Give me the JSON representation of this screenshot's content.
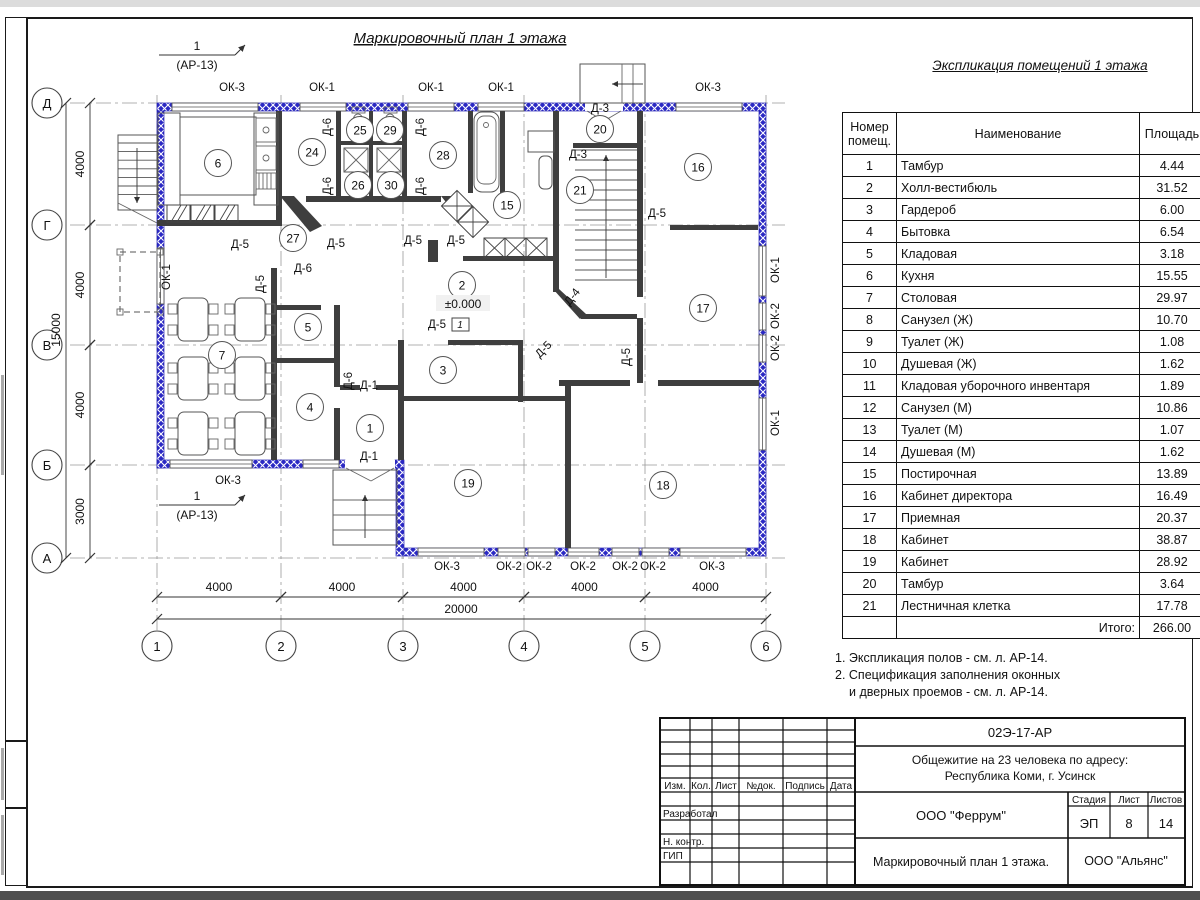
{
  "plan": {
    "title": "Маркировочный план 1 этажа",
    "axis_cols": [
      {
        "t": "1",
        "x": 157
      },
      {
        "t": "2",
        "x": 281
      },
      {
        "t": "3",
        "x": 403
      },
      {
        "t": "4",
        "x": 524
      },
      {
        "t": "5",
        "x": 645
      },
      {
        "t": "6",
        "x": 766
      }
    ],
    "axis_rows": [
      {
        "t": "Д",
        "y": 103
      },
      {
        "t": "Г",
        "y": 225
      },
      {
        "t": "В",
        "y": 345
      },
      {
        "t": "Б",
        "y": 465
      },
      {
        "t": "А",
        "y": 558
      }
    ],
    "dims_bottom": {
      "spans": [
        {
          "t": "4000",
          "a": 157,
          "b": 281
        },
        {
          "t": "4000",
          "a": 281,
          "b": 403
        },
        {
          "t": "4000",
          "a": 403,
          "b": 524
        },
        {
          "t": "4000",
          "a": 524,
          "b": 645
        },
        {
          "t": "4000",
          "a": 645,
          "b": 766
        }
      ],
      "total": "20000"
    },
    "dims_left": {
      "spans": [
        {
          "t": "4000",
          "a": 103,
          "b": 225
        },
        {
          "t": "4000",
          "a": 225,
          "b": 345
        },
        {
          "t": "4000",
          "a": 345,
          "b": 465
        },
        {
          "t": "3000",
          "a": 465,
          "b": 558
        }
      ],
      "total": "15000"
    },
    "window_labels": [
      {
        "t": "ОК-3",
        "x": 232,
        "y": 91
      },
      {
        "t": "ОК-1",
        "x": 322,
        "y": 91
      },
      {
        "t": "ОК-1",
        "x": 431,
        "y": 91
      },
      {
        "t": "ОК-1",
        "x": 501,
        "y": 91
      },
      {
        "t": "ОК-3",
        "x": 708,
        "y": 91
      },
      {
        "t": "ОК-3",
        "x": 228,
        "y": 484
      },
      {
        "t": "ОК-3",
        "x": 447,
        "y": 570
      },
      {
        "t": "ОК-2",
        "x": 509,
        "y": 570
      },
      {
        "t": "ОК-2",
        "x": 539,
        "y": 570
      },
      {
        "t": "ОК-2",
        "x": 583,
        "y": 570
      },
      {
        "t": "ОК-2",
        "x": 625,
        "y": 570
      },
      {
        "t": "ОК-2",
        "x": 653,
        "y": 570
      },
      {
        "t": "ОК-3",
        "x": 712,
        "y": 570
      },
      {
        "t": "ОК-1",
        "x": 779,
        "y": 270,
        "r": -90
      },
      {
        "t": "ОК-2",
        "x": 779,
        "y": 316,
        "r": -90
      },
      {
        "t": "ОК-2",
        "x": 779,
        "y": 348,
        "r": -90
      },
      {
        "t": "ОК-1",
        "x": 779,
        "y": 423,
        "r": -90
      },
      {
        "t": "ОК-1",
        "x": 170,
        "y": 277,
        "r": -90
      }
    ],
    "door_labels": [
      {
        "t": "Д-6",
        "x": 331,
        "y": 127,
        "r": -90
      },
      {
        "t": "Д-6",
        "x": 424,
        "y": 127,
        "r": -90
      },
      {
        "t": "Д-6",
        "x": 331,
        "y": 186,
        "r": -90
      },
      {
        "t": "Д-6",
        "x": 424,
        "y": 186,
        "r": -90
      },
      {
        "t": "Д-3",
        "x": 600,
        "y": 112
      },
      {
        "t": "Д-3",
        "x": 578,
        "y": 158
      },
      {
        "t": "Д-5",
        "x": 657,
        "y": 217
      },
      {
        "t": "Д-5",
        "x": 240,
        "y": 248
      },
      {
        "t": "Д-5",
        "x": 336,
        "y": 247
      },
      {
        "t": "Д-6",
        "x": 303,
        "y": 272
      },
      {
        "t": "Д-5",
        "x": 264,
        "y": 284,
        "r": -90
      },
      {
        "t": "Д-5",
        "x": 413,
        "y": 244
      },
      {
        "t": "Д-5",
        "x": 456,
        "y": 244
      },
      {
        "t": "Д-6",
        "x": 352,
        "y": 381,
        "r": -90
      },
      {
        "t": "Д-1",
        "x": 369,
        "y": 389
      },
      {
        "t": "Д-1",
        "x": 369,
        "y": 460
      },
      {
        "t": "Д-5",
        "x": 437,
        "y": 328
      },
      {
        "t": "Д-4",
        "x": 575,
        "y": 299,
        "r": -52
      },
      {
        "t": "Д-5",
        "x": 630,
        "y": 357,
        "r": -90
      },
      {
        "t": "Д-5",
        "x": 546,
        "y": 352,
        "r": -45
      }
    ],
    "rooms": [
      {
        "n": "1",
        "x": 370,
        "y": 428
      },
      {
        "n": "2",
        "x": 462,
        "y": 285
      },
      {
        "n": "3",
        "x": 443,
        "y": 370
      },
      {
        "n": "4",
        "x": 310,
        "y": 407
      },
      {
        "n": "5",
        "x": 308,
        "y": 327
      },
      {
        "n": "6",
        "x": 218,
        "y": 163
      },
      {
        "n": "7",
        "x": 222,
        "y": 355
      },
      {
        "n": "15",
        "x": 507,
        "y": 205
      },
      {
        "n": "16",
        "x": 698,
        "y": 167
      },
      {
        "n": "17",
        "x": 703,
        "y": 308
      },
      {
        "n": "18",
        "x": 663,
        "y": 485
      },
      {
        "n": "19",
        "x": 468,
        "y": 483
      },
      {
        "n": "20",
        "x": 600,
        "y": 129
      },
      {
        "n": "21",
        "x": 580,
        "y": 190
      },
      {
        "n": "24",
        "x": 312,
        "y": 152
      },
      {
        "n": "25",
        "x": 360,
        "y": 130
      },
      {
        "n": "26",
        "x": 358,
        "y": 185
      },
      {
        "n": "27",
        "x": 293,
        "y": 238
      },
      {
        "n": "28",
        "x": 443,
        "y": 155
      },
      {
        "n": "29",
        "x": 390,
        "y": 130
      },
      {
        "n": "30",
        "x": 391,
        "y": 185
      }
    ],
    "section_markers": [
      {
        "num": "1",
        "ref": "(АР-13)",
        "x": 197,
        "y": 55
      },
      {
        "num": "1",
        "ref": "(АР-13)",
        "x": 197,
        "y": 505
      }
    ],
    "level_mark": "±0.000",
    "floor_mark": "1"
  },
  "schedule": {
    "title": "Экспликация помещений 1 этажа",
    "headers": {
      "num1": "Номер",
      "num2": "помещ.",
      "name": "Наименование",
      "area": "Площадь",
      "cut1": "Ка",
      "cut2": "по"
    },
    "rows": [
      {
        "n": "1",
        "name": "Тамбур",
        "area": "4.44"
      },
      {
        "n": "2",
        "name": "Холл-вестибюль",
        "area": "31.52"
      },
      {
        "n": "3",
        "name": "Гардероб",
        "area": "6.00"
      },
      {
        "n": "4",
        "name": "Бытовка",
        "area": "6.54"
      },
      {
        "n": "5",
        "name": "Кладовая",
        "area": "3.18"
      },
      {
        "n": "6",
        "name": "Кухня",
        "area": "15.55"
      },
      {
        "n": "7",
        "name": "Столовая",
        "area": "29.97"
      },
      {
        "n": "8",
        "name": "Санузел (Ж)",
        "area": "10.70"
      },
      {
        "n": "9",
        "name": "Туалет (Ж)",
        "area": "1.08"
      },
      {
        "n": "10",
        "name": "Душевая (Ж)",
        "area": "1.62"
      },
      {
        "n": "11",
        "name": "Кладовая уборочного инвентаря",
        "area": "1.89"
      },
      {
        "n": "12",
        "name": "Санузел (М)",
        "area": "10.86"
      },
      {
        "n": "13",
        "name": "Туалет (М)",
        "area": "1.07"
      },
      {
        "n": "14",
        "name": "Душевая (М)",
        "area": "1.62"
      },
      {
        "n": "15",
        "name": "Постирочная",
        "area": "13.89"
      },
      {
        "n": "16",
        "name": "Кабинет директора",
        "area": "16.49"
      },
      {
        "n": "17",
        "name": "Приемная",
        "area": "20.37"
      },
      {
        "n": "18",
        "name": "Кабинет",
        "area": "38.87"
      },
      {
        "n": "19",
        "name": "Кабинет",
        "area": "28.92"
      },
      {
        "n": "20",
        "name": "Тамбур",
        "area": "3.64"
      },
      {
        "n": "21",
        "name": "Лестничная клетка",
        "area": "17.78"
      }
    ],
    "total_label": "Итого:",
    "total": "266.00"
  },
  "notes": [
    {
      "text": "1. Экспликация полов - см. л. АР-14.",
      "indent": false
    },
    {
      "text": "2. Спецификация заполнения оконных",
      "indent": false
    },
    {
      "text": "и дверных проемов - см. л. АР-14.",
      "indent": true
    }
  ],
  "titleblock": {
    "labels": [
      {
        "t": "Изм.",
        "x": 675,
        "y": 789,
        "s": 10,
        "a": "middle"
      },
      {
        "t": "Кол.",
        "x": 701,
        "y": 789,
        "s": 10,
        "a": "middle"
      },
      {
        "t": "Лист",
        "x": 726,
        "y": 789,
        "s": 10,
        "a": "middle"
      },
      {
        "t": "№док.",
        "x": 761,
        "y": 789,
        "s": 10,
        "a": "middle"
      },
      {
        "t": "Подпись",
        "x": 805,
        "y": 789,
        "s": 10,
        "a": "middle"
      },
      {
        "t": "Дата",
        "x": 841,
        "y": 789,
        "s": 10,
        "a": "middle"
      },
      {
        "t": "Разработал",
        "x": 663,
        "y": 817,
        "s": 10,
        "a": "start"
      },
      {
        "t": "Н. контр.",
        "x": 663,
        "y": 845,
        "s": 10,
        "a": "start"
      },
      {
        "t": "ГИП",
        "x": 663,
        "y": 859,
        "s": 10,
        "a": "start"
      },
      {
        "t": "02Э-17-АР",
        "x": 1020,
        "y": 737,
        "s": 13,
        "a": "middle"
      },
      {
        "t": "Общежитие на 23 человека по адресу:",
        "x": 1020,
        "y": 764,
        "s": 12,
        "a": "middle"
      },
      {
        "t": "Республика Коми, г. Усинск",
        "x": 1020,
        "y": 780,
        "s": 12,
        "a": "middle"
      },
      {
        "t": "ООО \"Феррум\"",
        "x": 961,
        "y": 820,
        "s": 13,
        "a": "middle"
      },
      {
        "t": "Стадия",
        "x": 1089,
        "y": 803,
        "s": 10,
        "a": "middle"
      },
      {
        "t": "Лист",
        "x": 1129,
        "y": 803,
        "s": 10,
        "a": "middle"
      },
      {
        "t": "Листов",
        "x": 1166,
        "y": 803,
        "s": 10,
        "a": "middle"
      },
      {
        "t": "ЭП",
        "x": 1089,
        "y": 828,
        "s": 13,
        "a": "middle"
      },
      {
        "t": "8",
        "x": 1129,
        "y": 828,
        "s": 13,
        "a": "middle"
      },
      {
        "t": "14",
        "x": 1166,
        "y": 828,
        "s": 13,
        "a": "middle"
      },
      {
        "t": "Маркировочный план 1 этажа.",
        "x": 961,
        "y": 866,
        "s": 12.5,
        "a": "middle"
      },
      {
        "t": "ООО \"Альянс\"",
        "x": 1126,
        "y": 865,
        "s": 12.5,
        "a": "middle"
      }
    ]
  }
}
